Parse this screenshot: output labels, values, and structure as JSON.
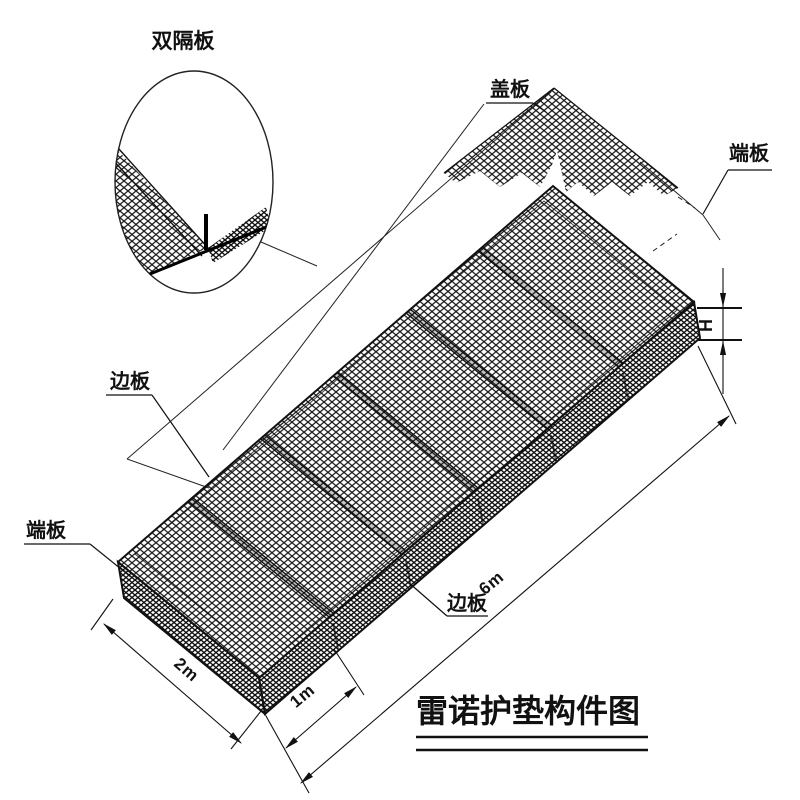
{
  "drawing": {
    "title": "雷诺护垫构件图",
    "labels": {
      "double_diaphragm": "双隔板",
      "cover_plate": "盖板",
      "end_plate_right": "端板",
      "side_plate_left": "边板",
      "end_plate_bottom_left": "端板",
      "side_plate_bottom": "边板"
    },
    "dimensions": {
      "width": "2m",
      "cell": "1m",
      "length": "6m",
      "height": "H"
    },
    "colors": {
      "line": "#1a1a1a",
      "background": "#ffffff"
    }
  }
}
